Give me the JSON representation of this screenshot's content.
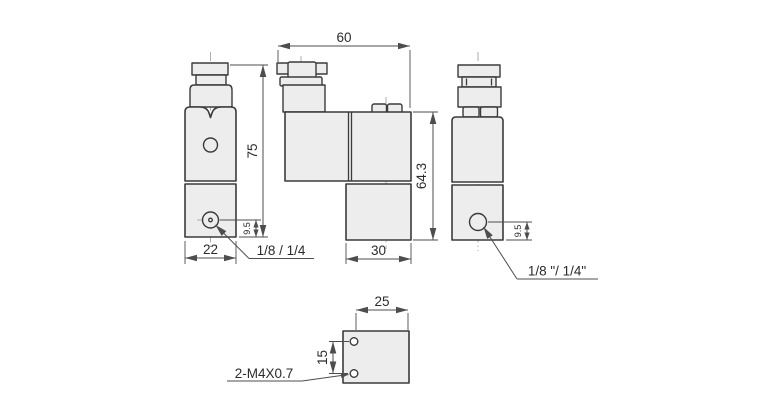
{
  "views": {
    "front": {
      "dim_height": "75",
      "dim_width": "22",
      "dim_port_offset": "9.5",
      "port_label": "1/8 / 1/4"
    },
    "side": {
      "dim_length": "60",
      "dim_height": "64.3",
      "dim_body_width": "30"
    },
    "rear": {
      "dim_port_offset": "9.5",
      "port_label": "1/8 \"/ 1/4\""
    },
    "bottom": {
      "dim_width": "25",
      "dim_hole_spacing": "15",
      "thread_label": "2-M4X0.7"
    }
  },
  "colors": {
    "background": "#ffffff",
    "fill": "#ededed",
    "line": "#3b3b3b",
    "dim": "#4d4d4d",
    "center": "#9a9a9a",
    "text": "#2b2b2b"
  }
}
